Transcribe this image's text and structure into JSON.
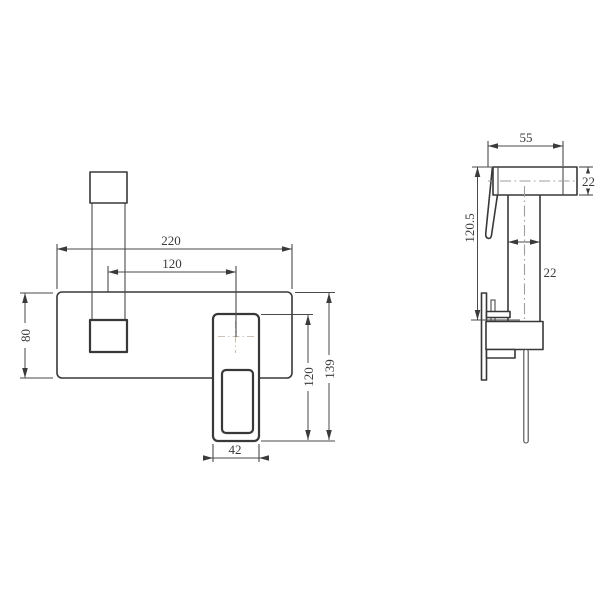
{
  "colors": {
    "background": "#ffffff",
    "outline": "#383838",
    "dimension_line": "#4a4a4a",
    "centerline_front": "#cdc3b5",
    "centerline_side": "#9e9e9e",
    "text": "#3a3a3a"
  },
  "front_view": {
    "dim_plate_width": "220",
    "dim_handle_to_spout_center": "120",
    "dim_plate_height": "80",
    "dim_spout_height": "120",
    "dim_total_height": "139",
    "dim_spout_width": "42"
  },
  "side_view": {
    "dim_head_length": "55",
    "dim_head_height": "22",
    "dim_overall_depth": "120.5",
    "dim_body_width": "22"
  }
}
